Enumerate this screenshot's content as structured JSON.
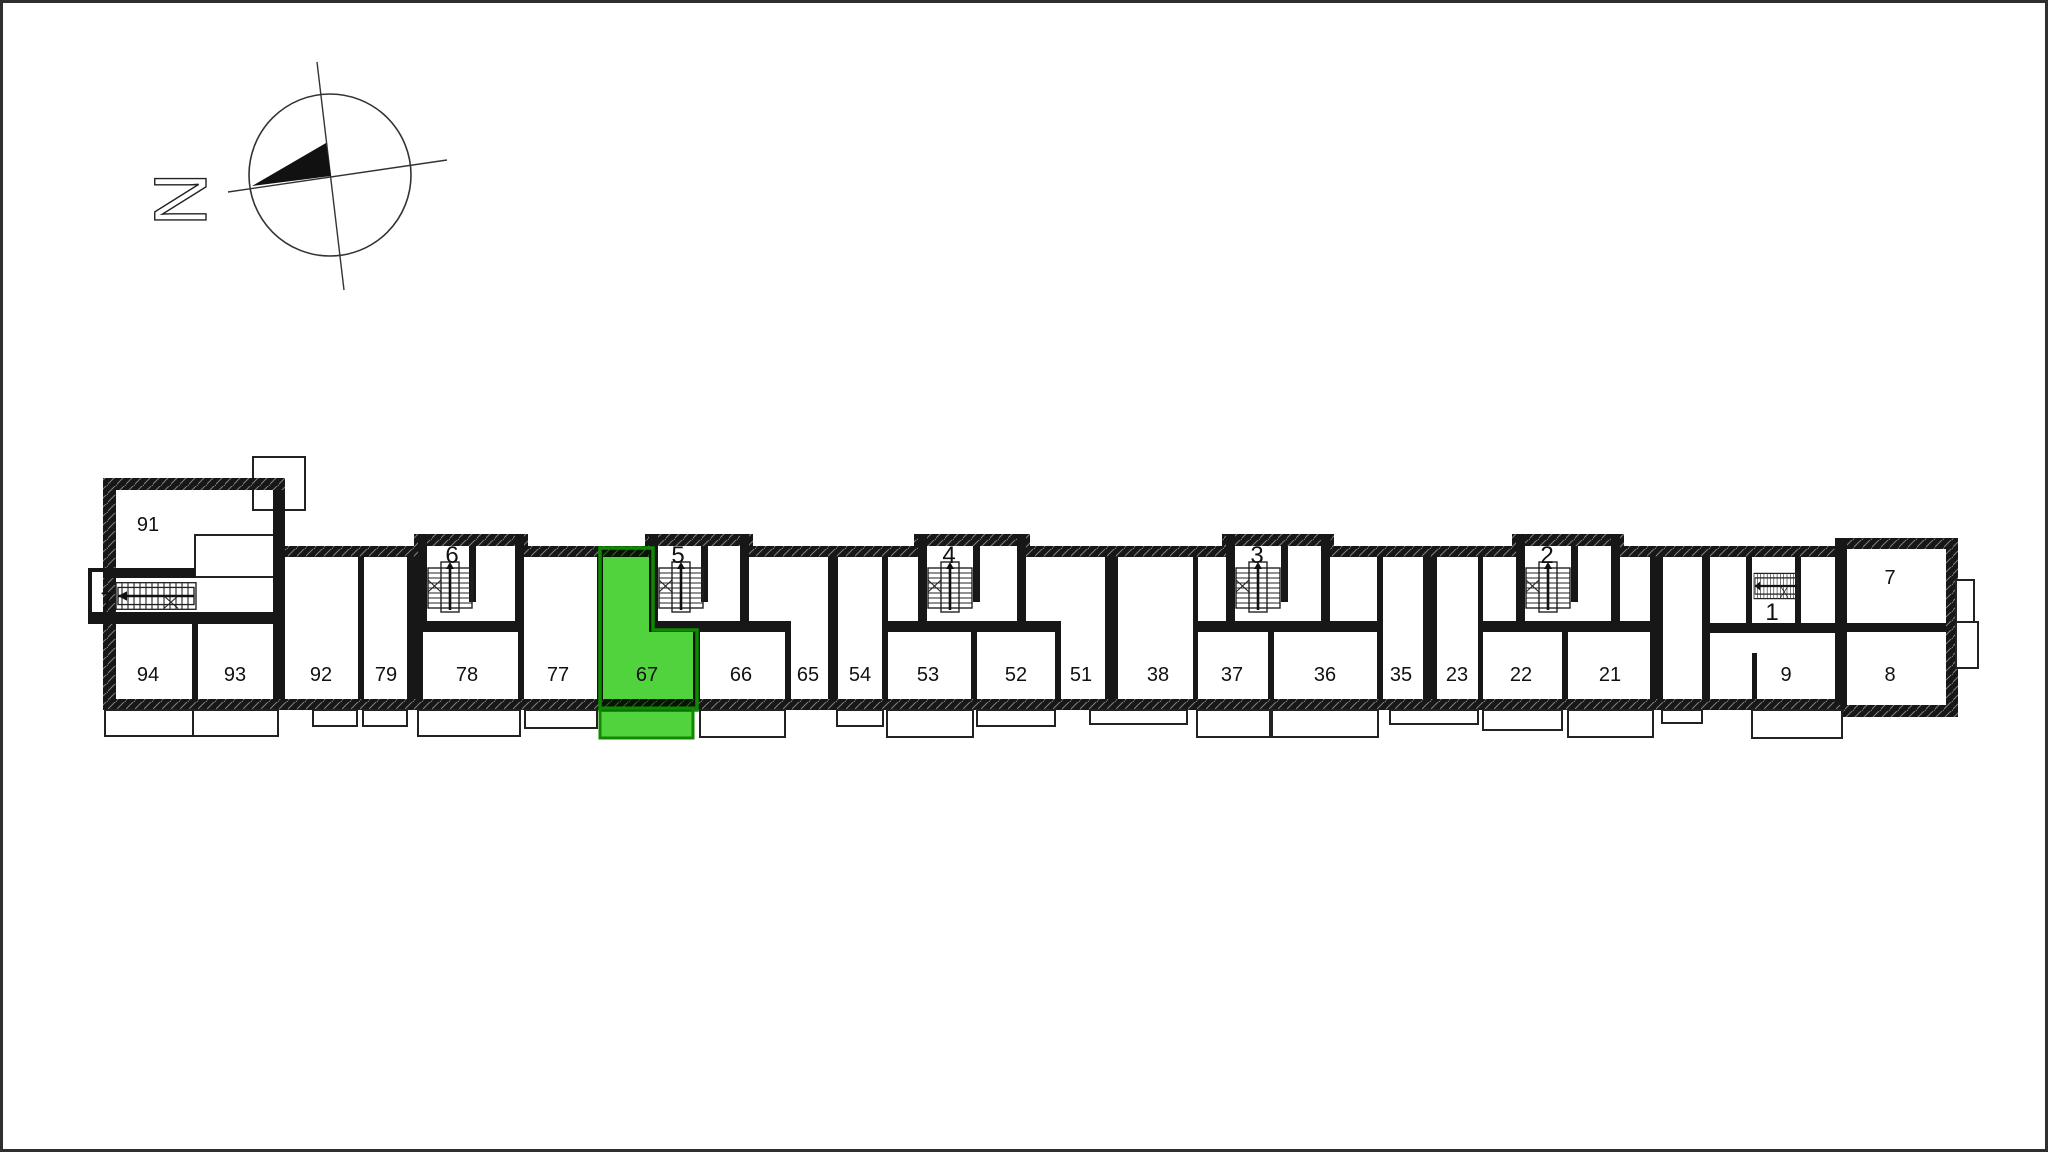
{
  "canvas": {
    "width": 2048,
    "height": 1152,
    "background": "#ffffff",
    "frame_color": "#2f2f2f"
  },
  "compass": {
    "north_label": "N"
  },
  "colors": {
    "wall": "#171717",
    "line": "#222222",
    "highlight_fill": "#50d33c",
    "highlight_border": "#0f8a00",
    "highlight_label": "#3d643a"
  },
  "highlighted_unit": {
    "label": "67"
  },
  "apartments": [
    "91",
    "94",
    "93",
    "92",
    "79",
    "78",
    "77",
    "67",
    "66",
    "65",
    "54",
    "53",
    "52",
    "51",
    "38",
    "37",
    "36",
    "35",
    "23",
    "22",
    "21",
    "9",
    "8",
    "7"
  ],
  "entrances": [
    "7",
    "6",
    "5",
    "4",
    "3",
    "2",
    "1"
  ]
}
